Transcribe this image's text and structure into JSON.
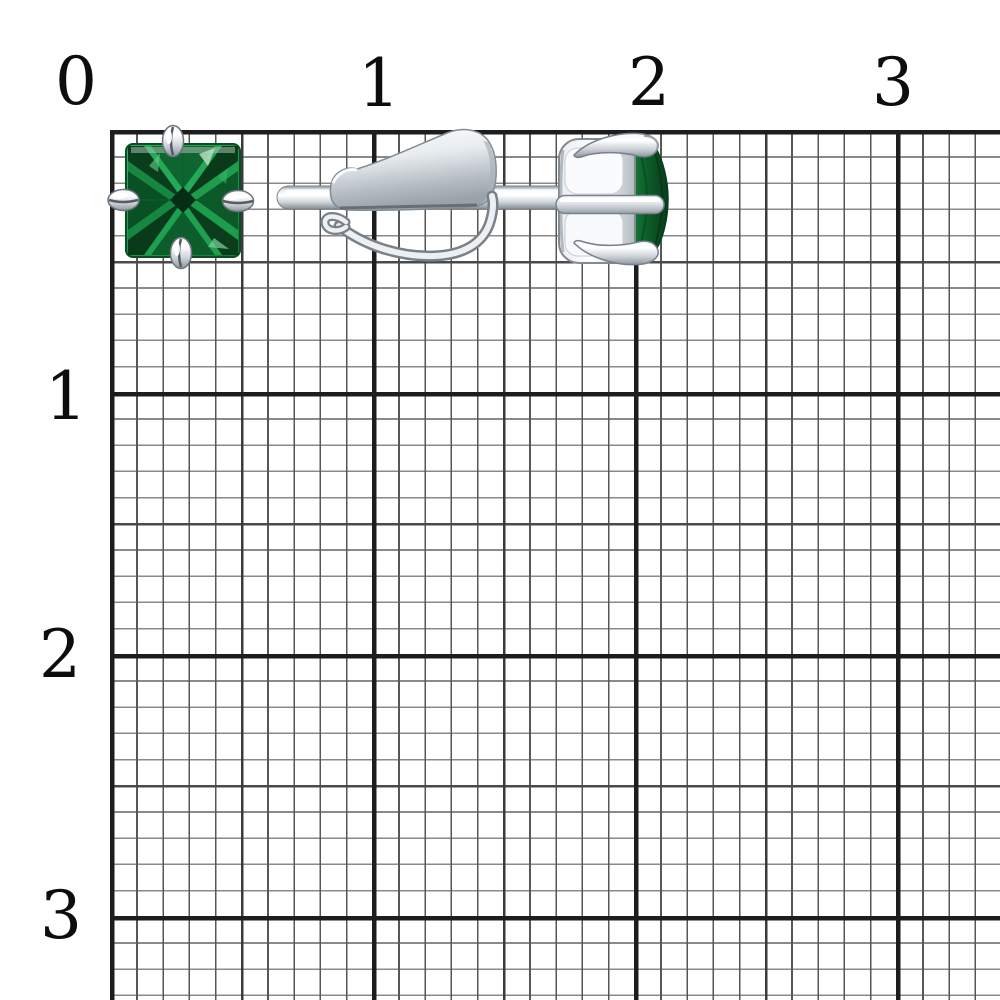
{
  "scale": {
    "top_labels": [
      "0",
      "1",
      "2",
      "3"
    ],
    "left_labels": [
      "1",
      "2",
      "3"
    ]
  },
  "figures": {
    "front_view": "stud-earring-front-view",
    "side_view": "stud-earring-side-view",
    "gem_cut": "princess-square",
    "prong_count": "4"
  },
  "colors": {
    "background": "#ffffff",
    "grid_fine": "#6a6a6a",
    "grid_medium": "#3e3e3e",
    "grid_thick": "#1d1d1d",
    "label_text": "#0d0d0d",
    "gem_green_bright": "#23a553",
    "gem_green_mid": "#0f7a37",
    "gem_green_dark": "#083a1b",
    "metal_highlight": "#ffffff",
    "metal_mid": "#c3cad0",
    "metal_shadow": "#868e95"
  }
}
